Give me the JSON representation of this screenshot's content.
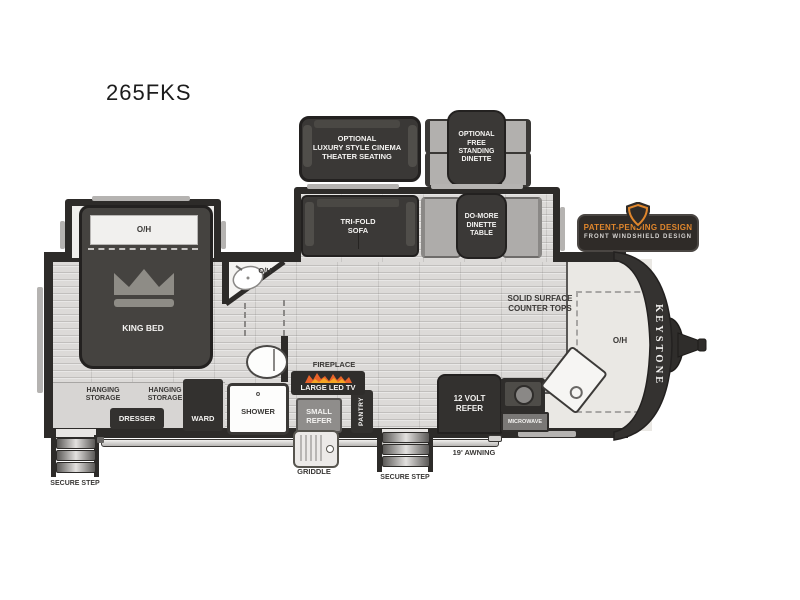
{
  "title": "265FKS",
  "colors": {
    "wall": "#2d2b29",
    "accent_orange": "#e0862c",
    "floor": "#dcdad8",
    "counter": "#eae8e4",
    "dark_furniture": "#33312f",
    "bench_gray": "#aeacaa"
  },
  "icons": {
    "crown": "crown-icon (filled gray crown svg)",
    "shield": "shield-icon (orange outlined crest)",
    "flames": "flames-icon (fireplace fire)"
  },
  "options": {
    "cinema_label": "OPTIONAL\nLUXURY STYLE CINEMA\nTHEATER SEATING",
    "free_dinette_label": "OPTIONAL\nFREE\nSTANDING\nDINETTE"
  },
  "badge": {
    "line1": "PATENT-PENDING DESIGN",
    "line2": "FRONT WINDSHIELD DESIGN"
  },
  "slideout": {
    "sofa": "TRI-FOLD\nSOFA",
    "dinette_table": "DO-MORE\nDINETTE\nTABLE"
  },
  "bedroom": {
    "overhead": "O/H",
    "bed": "KING BED",
    "hanging_storage_1": "HANGING\nSTORAGE",
    "hanging_storage_2": "HANGING\nSTORAGE",
    "dresser": "DRESSER",
    "wardrobe": "WARD"
  },
  "bathroom": {
    "overhead": "O/H",
    "shower": "SHOWER",
    "shower_handle": "o"
  },
  "living": {
    "fireplace": "FIREPLACE",
    "tv": "LARGE LED TV",
    "small_refer": "SMALL\nREFER",
    "pantry": "PANTRY"
  },
  "kitchen": {
    "refer": "12 VOLT\nREFER",
    "microwave": "MICROWAVE",
    "counter": "SOLID SURFACE\nCOUNTER TOPS",
    "overhead": "O/H"
  },
  "brand": {
    "name": "KEYSTONE"
  },
  "exterior": {
    "secure_step_left": "SECURE STEP",
    "secure_step_right": "SECURE STEP",
    "awning": "19' AWNING",
    "griddle": "GRIDDLE"
  }
}
